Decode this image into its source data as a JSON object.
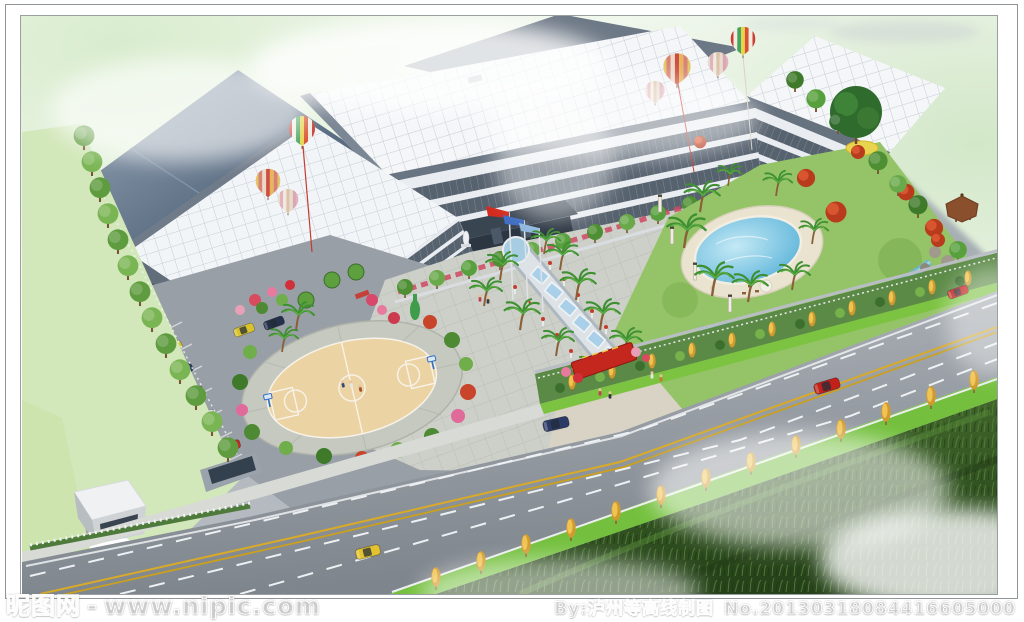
{
  "watermark": {
    "site_name": "昵图网",
    "separator": "-",
    "site_url": "www.nipic.com",
    "credit": "By:泸州等高线制图",
    "serial": "No.20130318084416605000"
  },
  "scene": {
    "type": "aerial architectural rendering",
    "description": "Bird's-eye color rendering of a factory / office campus: industrial halls with white grid roofs and slate roofs, a long banded glass facade with entrance canopy and flag poles, a landscaped garden with swimming pool, gazebo, rockery stream and palm trees, a round basketball court plaza, a parking lot with gate house, decorative rainbow hot-air balloons over the roofs, and a wide tree-lined highway with cars in the foreground fading into a misty grass field.",
    "objects": [
      "slate-roof-warehouse",
      "white-grid-roof-halls",
      "main-office-facade",
      "entrance-canopy",
      "flag-poles",
      "welcome-sign",
      "central-water-axis",
      "basketball-court",
      "parking-lot",
      "gate-house",
      "boom-barrier",
      "swimming-pool",
      "gazebo",
      "rockery-stream",
      "big-garden-tree",
      "palm-trees",
      "flame-red-trees",
      "roadside-yellow-trees",
      "hot-air-balloons",
      "highway",
      "taxi",
      "sedans",
      "pedestrians",
      "grass-field",
      "mist"
    ],
    "palette": {
      "sky_green": "#dcedd2",
      "roof_white": "#f4f6f8",
      "roof_slate": "#4c5c70",
      "facade_band": "#57626f",
      "facade_light": "#e9edf1",
      "road_gray": "#9aa1a8",
      "lane_yellow": "#d8aa28",
      "grass_bright": "#74c03e",
      "grass_dark": "#2c4a1c",
      "pool_blue": "#4fadd6",
      "court_tan": "#ecd3a4",
      "tree_green": "#4f8f33",
      "autumn_yellow": "#e0a830",
      "flame_red": "#b93b1e",
      "balloon_red": "#c93f33",
      "watermark_white": "#ffffff"
    }
  }
}
